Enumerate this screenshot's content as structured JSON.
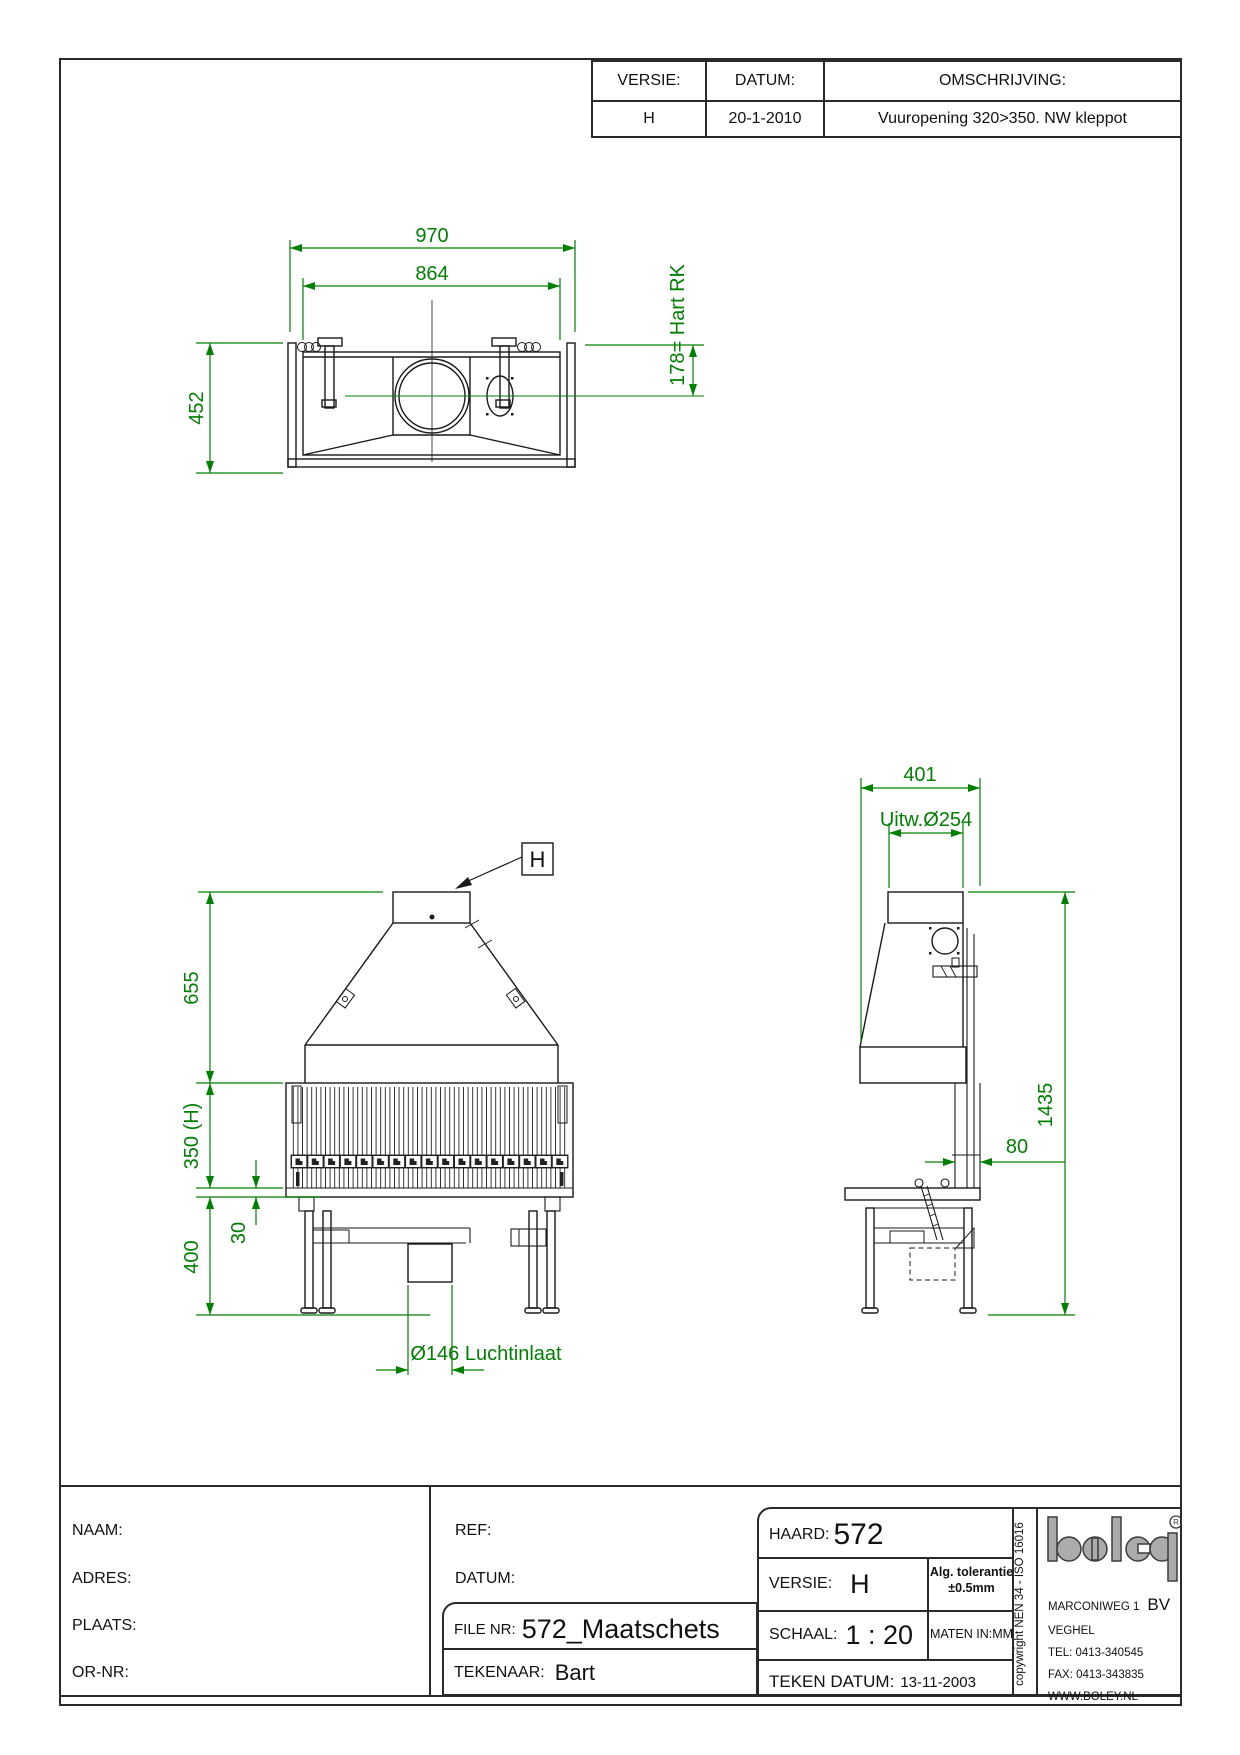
{
  "colors": {
    "dimension_green": "#008000",
    "drawing_black": "#1a1a1a",
    "logo_gray": "#ababab"
  },
  "revision_table": {
    "headers": {
      "versie": "VERSIE:",
      "datum": "DATUM:",
      "omschrijving": "OMSCHRIJVING:"
    },
    "row": {
      "versie": "H",
      "datum": "20-1-2010",
      "omschrijving": "Vuuropening 320>350. NW kleppot"
    }
  },
  "dims": {
    "top": {
      "outer_width": "970",
      "inner_width": "864",
      "depth": "452",
      "flue_center": "178= Hart RK"
    },
    "front": {
      "hood_height": "655",
      "opening_height": "350 (H)",
      "grate_offset": "30",
      "base_height": "400",
      "air_inlet": "Ø146 Luchtinlaat",
      "callout": "H"
    },
    "side": {
      "top_depth": "401",
      "flue_diameter": "Uitw.Ø254",
      "total_height": "1435",
      "back_width": "80"
    }
  },
  "title_block": {
    "naam": "NAAM:",
    "adres": "ADRES:",
    "plaats": "PLAATS:",
    "ornr": "OR-NR:",
    "ref": "REF:",
    "datum": "DATUM:",
    "file_label": "FILE NR:",
    "file_value": "572_Maatschets",
    "tekenaar_label": "TEKENAAR:",
    "tekenaar_value": "Bart",
    "haard_label": "HAARD:",
    "haard_value": "572",
    "versie_label": "VERSIE:",
    "versie_value": "H",
    "tolerantie_line1": "Alg. tolerantie",
    "tolerantie_line2": "±0.5mm",
    "schaal_label": "SCHAAL:",
    "schaal_value": "1 : 20",
    "maten": "MATEN IN:MM",
    "teken_datum_label": "TEKEN DATUM:",
    "teken_datum_value": "13-11-2003",
    "copyright": "copywright NEN 34 - ISO 16016",
    "company": {
      "brand": "boley",
      "reg": "®",
      "address1": "MARCONIWEG 1",
      "bv": "BV",
      "address2": "VEGHEL",
      "tel": "TEL: 0413-340545",
      "fax": "FAX: 0413-343835",
      "web": "WWW.BOLEY.NL"
    }
  }
}
